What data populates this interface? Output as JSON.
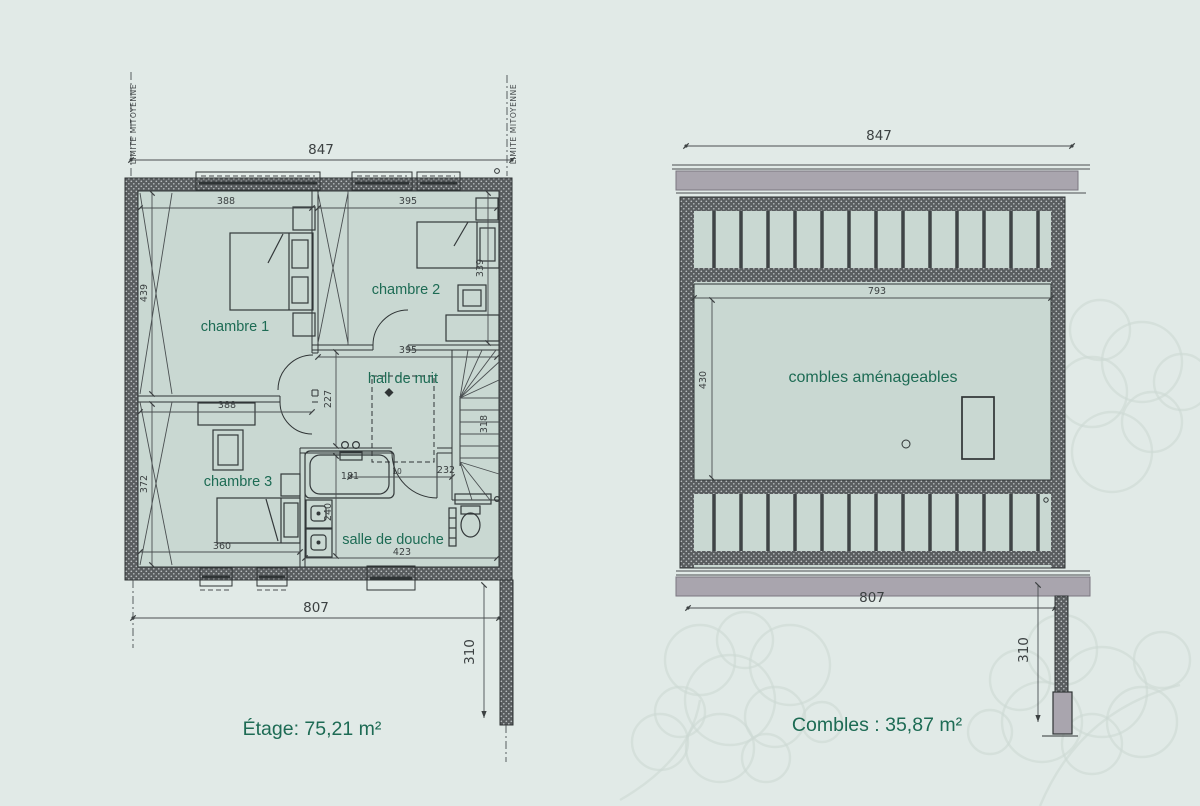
{
  "colors": {
    "background": "#e1eae7",
    "room_fill": "#c9d8d2",
    "wall_dark": "#595d5f",
    "line": "#3c4142",
    "accent_text": "#1d6b54",
    "eave_gray": "#a9a5ae",
    "watermark": "#cdd9d3"
  },
  "left_plan": {
    "party_wall_label_left": "LIMITE MITOYENNE",
    "party_wall_label_right": "LIMITE MITOYENNE",
    "rooms": {
      "bedroom1": "chambre 1",
      "bedroom2": "chambre 2",
      "bedroom3": "chambre 3",
      "hall": "hall de nuit",
      "shower_room": "salle de douche"
    },
    "dims": {
      "overall_width": "847",
      "bedroom1_width": "388",
      "bedroom2_width": "395",
      "bedroom1_height": "439",
      "bedroom2_height": "339",
      "hall_width": "395",
      "hall_height": "227",
      "stair_run": "318",
      "partition_width": "388",
      "bedroom3_height": "372",
      "bath_length": "181",
      "bath_gap": "10",
      "bath_row": "232",
      "basin_run": "240",
      "shower_room_width": "423",
      "bedroom3_width": "360",
      "overall_bottom": "807",
      "party_wall_return": "310"
    },
    "area_title": "Étage: 75,21 m²"
  },
  "right_plan": {
    "rooms": {
      "attic": "combles aménageables"
    },
    "dims": {
      "overall_width": "847",
      "inner_width": "793",
      "inner_height": "430",
      "overall_bottom": "807",
      "party_wall_return": "310"
    },
    "area_title": "Combles : 35,87 m²"
  }
}
